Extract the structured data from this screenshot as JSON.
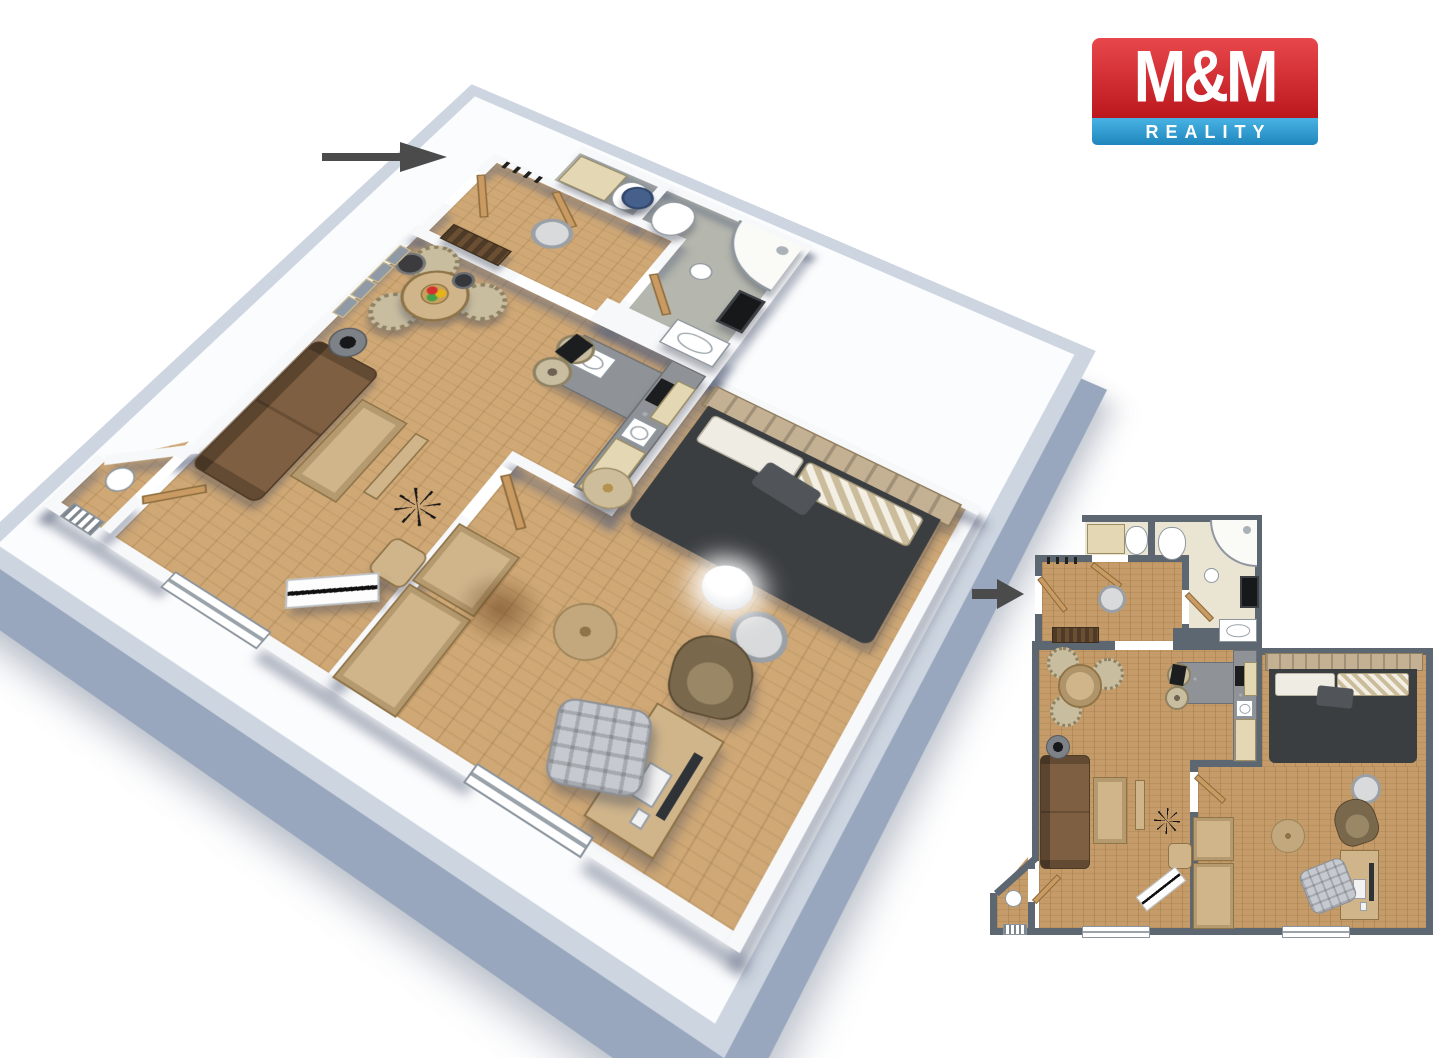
{
  "page": {
    "width": 1440,
    "height": 1018,
    "background": "#ffffff"
  },
  "logo": {
    "top_text": "M&M",
    "bottom_text": "REALITY"
  },
  "arrows": [
    {
      "id": "entrance-arrow-3d",
      "direction": "right"
    },
    {
      "id": "entrance-arrow-2d",
      "direction": "right"
    }
  ],
  "colors": {
    "--c-arrow": "#4b4b4b",
    "--c-logo-red1": "#e8474b",
    "--c-logo-red2": "#bb181e",
    "--c-logo-blue1": "#49b3e4",
    "--c-logo-blue2": "#1f86bd",
    "--c-wall2d": "#5d6771",
    "--c-wall3d": "#f7f8fa",
    "--c-wall3d-top": "#cdd5e0",
    "--c-wall3d-side": "#98a7bd",
    "--c-wood3d": "#cfa876",
    "--c-wood2d": "#c59c69",
    "--c-tile2d": "#eae4d3",
    "--c-tile3d": "#b5b7ae",
    "--c-sofa": "#7e5f41",
    "--c-bed": "#3b3e41",
    "--c-headboard": "#c4b092",
    "--c-pillow": "#efece3",
    "--c-pillow-tan": "#cbbd9c",
    "--c-cabinet": "#e3d7b4",
    "--c-counter": "#8f9398",
    "--c-tan": "#d0b58b",
    "--c-chair": "#c9bda0",
    "--c-door": "#c99b62"
  },
  "floor_plan_3d": {
    "type": "3d-isometric-apartment-render",
    "rooms": [
      {
        "name": "entrance-hall",
        "furniture": [
          "entry-door",
          "coat-hooks",
          "shoe-bench",
          "wardrobe-cabinet",
          "blue-stool",
          "ceiling-light"
        ]
      },
      {
        "name": "wc",
        "furniture": [
          "toilet",
          "storage-cabinet"
        ]
      },
      {
        "name": "bathroom",
        "furniture": [
          "corner-shower",
          "toilet",
          "washbasin",
          "washing-machine",
          "stool"
        ]
      },
      {
        "name": "living-room-with-kitchenette",
        "furniture": [
          "sofa",
          "coffee-table",
          "tv-console",
          "round-dining-table",
          "dining-chairs",
          "fruit-bowl",
          "wall-pictures",
          "floor-lamp",
          "pendant-lamp",
          "plant",
          "pouf",
          "bench",
          "kitchen-counter",
          "sink",
          "cooktop",
          "bar-stools",
          "coffee-machine",
          "kitchen-cabinets"
        ]
      },
      {
        "name": "bedroom",
        "furniture": [
          "double-bed",
          "headboard",
          "pillows",
          "pouf",
          "sphere-floor-lamp",
          "round-rug",
          "bedside-table",
          "wardrobe",
          "desk",
          "computer-monitor",
          "keyboard",
          "office-chair",
          "armchair"
        ]
      }
    ]
  },
  "floor_plan_2d": {
    "type": "2d-top-down-floor-plan",
    "rooms": [
      {
        "name": "entrance-hall",
        "furniture": [
          "entry-door",
          "coat-hooks",
          "shoe-bench",
          "ceiling-light"
        ]
      },
      {
        "name": "wc",
        "furniture": [
          "toilet",
          "storage-cabinet"
        ]
      },
      {
        "name": "bathroom",
        "furniture": [
          "corner-shower",
          "toilet",
          "washbasin",
          "washing-machine",
          "stool"
        ]
      },
      {
        "name": "living-room-with-kitchenette",
        "furniture": [
          "sofa",
          "coffee-table",
          "tv-console",
          "round-dining-table",
          "dining-chairs",
          "plant",
          "pouf",
          "bench",
          "kitchen-counter",
          "cooktop",
          "bar-stools",
          "coffee-machine",
          "kitchen-cabinets",
          "balcony-table",
          "radiator",
          "windows"
        ]
      },
      {
        "name": "bedroom",
        "furniture": [
          "double-bed",
          "pillows",
          "round-rug",
          "bedside-table",
          "wardrobe",
          "desk",
          "computer-monitor",
          "keyboard",
          "office-chair",
          "armchair",
          "window"
        ]
      }
    ]
  }
}
